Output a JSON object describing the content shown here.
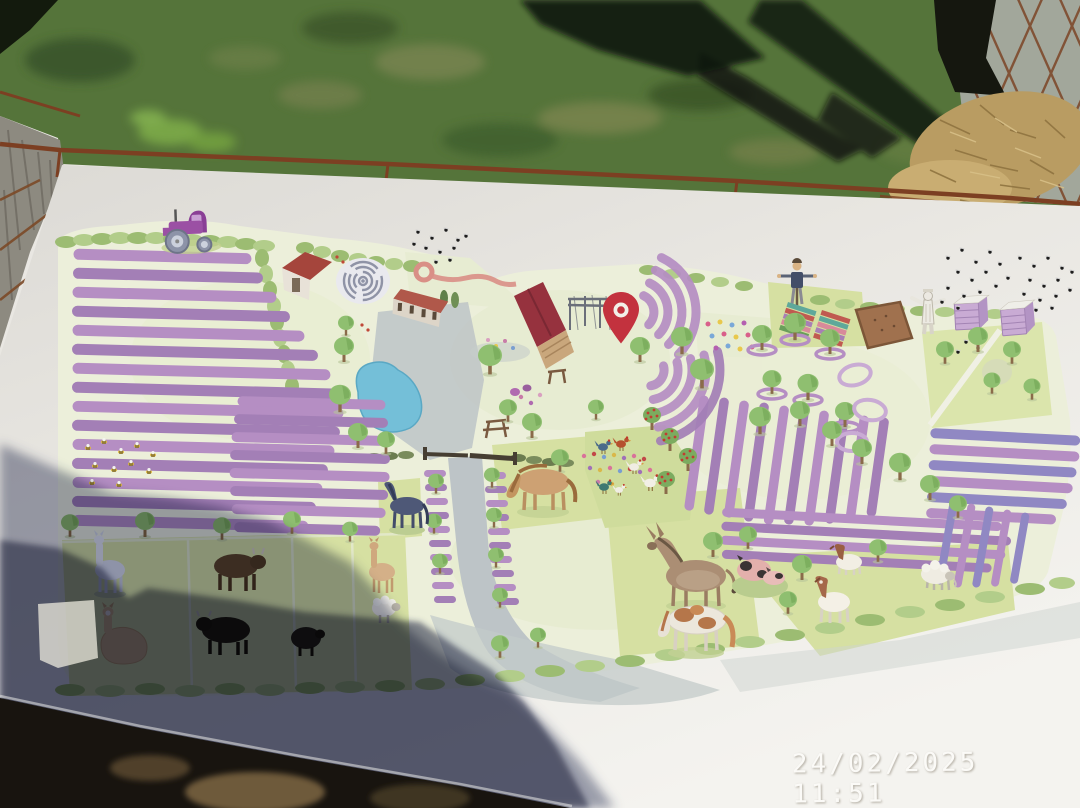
{
  "photo": {
    "camera_timestamp": "24/02/2025 11:51"
  },
  "colors": {
    "grass": "#55743a",
    "grass_shadow": "#131a0d",
    "table_white": "#e9e7e2",
    "wood_post": "#8d8a80",
    "rust_wire": "#7c3f22",
    "gravel": "#a2a79b",
    "straw": "#b99c62",
    "map_base": "#ecefda",
    "field_green": "#d6e0a2",
    "hedge_green": "#9cbc72",
    "tree_green": "#8fbf70",
    "lavender": "#b58ec3",
    "lavender_blue": "#9088c3",
    "pond_blue": "#74bfd8",
    "path_gray": "#bdc4c7",
    "barn_roof_red": "#96323e",
    "pin_red": "#c3323e",
    "tractor_purple": "#9b50a4",
    "beehive_purple": "#c9abd4",
    "photographer_shadow": "#1c2448",
    "timestamp_white": "#fbfaf7"
  },
  "scene": {
    "description": "hand-painted lavender farm map on a white table outdoors",
    "background_items": [
      "grass-lawn",
      "tree-shadows",
      "wooden-post",
      "rusty-wire-fence",
      "diamond-mesh-fence",
      "gravel",
      "straw-pile",
      "white-table",
      "photographer-shadow",
      "camera-timestamp"
    ],
    "map_features": [
      "purple-tractor",
      "lavender-field-left",
      "lavender-field-small",
      "honey-bees",
      "red-roof-shed",
      "labyrinth",
      "farm-building",
      "winding-trail",
      "parking-area",
      "pond",
      "main-barn",
      "pergola",
      "location-pin",
      "lavender-fan-rows",
      "flower-gardens",
      "picnic-tables",
      "scarecrow",
      "striped-planting-beds",
      "soil-bed",
      "beekeeper",
      "beehives",
      "bee-swarms",
      "orchard-with-lavender-rings",
      "right-orchard-field",
      "diagonal-lavender-rows",
      "horizontal-lavender-rows",
      "chicken-pen",
      "apple-trees",
      "central-path",
      "gate",
      "dark-horse",
      "pony",
      "donkey",
      "paint-horse",
      "pigs",
      "goats",
      "sheep",
      "white-llama",
      "brown-alpaca",
      "sitting-alpaca",
      "cows",
      "black-sheep",
      "left-paddocks",
      "hedge-border"
    ]
  }
}
